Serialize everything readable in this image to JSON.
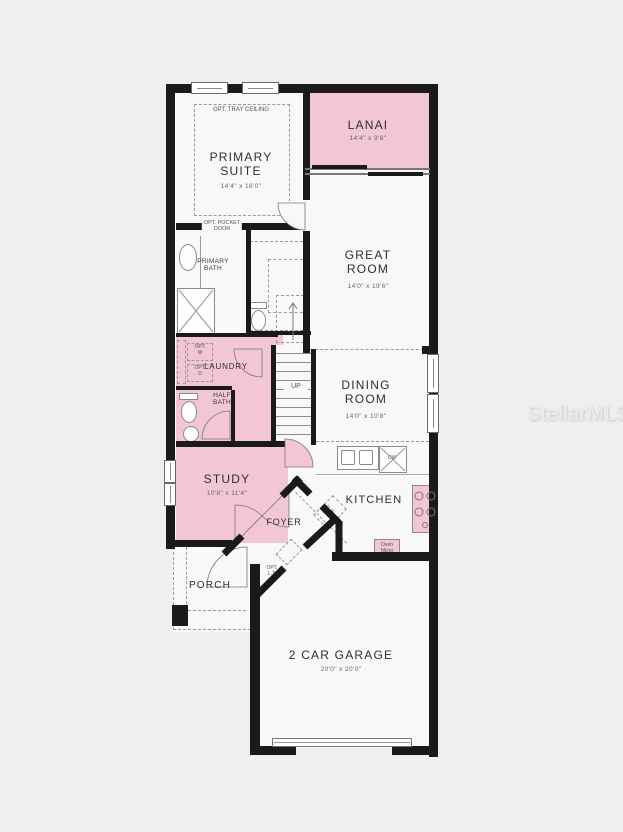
{
  "watermark": "StellarMLS",
  "rooms": {
    "primary_suite": {
      "name": "PRIMARY\nSUITE",
      "dims": "14'4\" x 16'0\""
    },
    "lanai": {
      "name": "LANAI",
      "dims": "14'4\" x 9'8\""
    },
    "great_room": {
      "name": "GREAT\nROOM",
      "dims": "14'0\" x 19'6\""
    },
    "dining_room": {
      "name": "DINING\nROOM",
      "dims": "14'0\" x 10'8\""
    },
    "kitchen": {
      "name": "KITCHEN"
    },
    "study": {
      "name": "STUDY",
      "dims": "10'8\" x 11'4\""
    },
    "laundry": {
      "name": "LAUNDRY"
    },
    "half_bath": {
      "name": "HALF\nBATH"
    },
    "primary_bath": {
      "name": "PRIMARY\nBATH"
    },
    "foyer": {
      "name": "FOYER"
    },
    "porch": {
      "name": "PORCH"
    },
    "garage": {
      "name": "2 CAR GARAGE",
      "dims": "20'0\" x 20'0\""
    }
  },
  "annotations": {
    "tray_ceiling": "OPT. TRAY CEILING",
    "pocket_door": "OPT. POCKET\nDOOR",
    "up": "UP",
    "opt_w": "OPT.\nW",
    "opt_d": "OPT.\nD",
    "opt_w_side": "OPT. W",
    "opt_d_side": "OPT. D",
    "opt_ref": "OPT.\nREF.",
    "opt_lt": "OPT.\nL.T.",
    "oven_micro": "Oven\nMicro",
    "dw": "DW"
  },
  "colors": {
    "background": "#efefef",
    "floor": "#f8f8f6",
    "highlight": "#f3c6d3",
    "wall": "#1a1a1a"
  }
}
